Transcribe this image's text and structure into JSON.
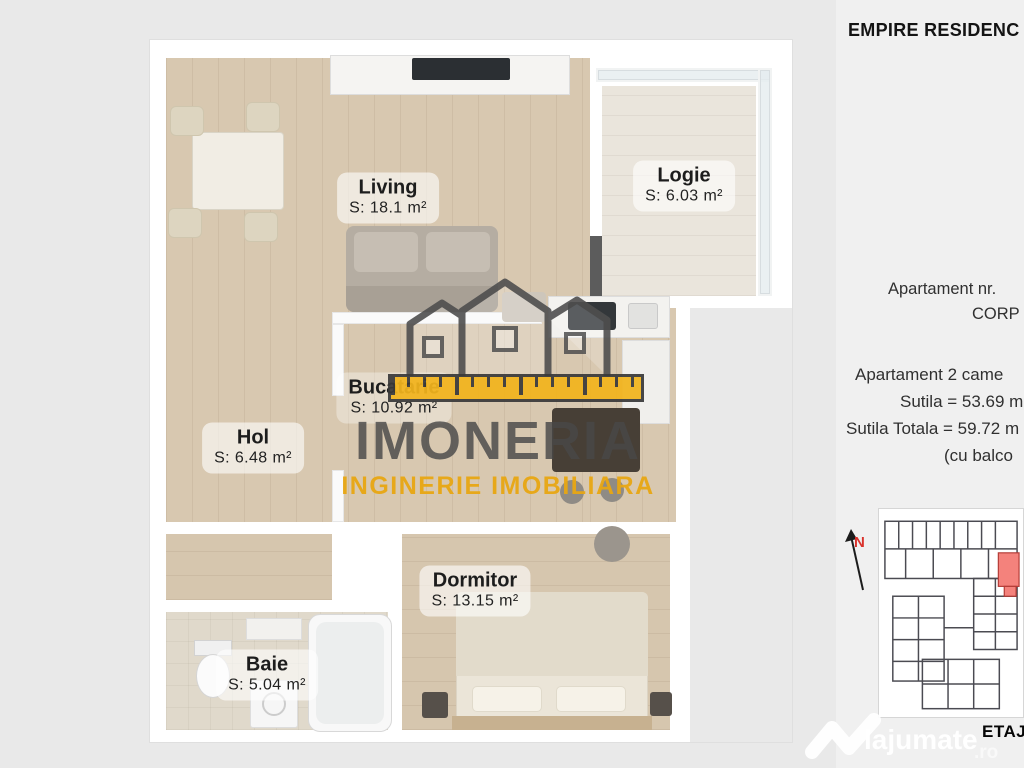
{
  "colors": {
    "background": "#e9e9e9",
    "panel_background": "#f0f0f0",
    "plan_background": "#ffffff",
    "wood_floor": "#d8c8b0",
    "brand_gray": "#4a4a4a",
    "brand_yellow": "#eead17",
    "highlight_red": "#f4827c"
  },
  "plan": {
    "rooms": [
      {
        "name": "Living",
        "area": "S: 18.1 m²"
      },
      {
        "name": "Logie",
        "area": "S: 6.03 m²"
      },
      {
        "name": "Bucatarie",
        "area": "S: 10.92 m²"
      },
      {
        "name": "Hol",
        "area": "S: 6.48 m²"
      },
      {
        "name": "Dormitor",
        "area": "S: 13.15 m²"
      },
      {
        "name": "Baie",
        "area": "S: 5.04 m²"
      }
    ],
    "watermark": {
      "brand": "IMONERIA",
      "tagline": "INGINERIE IMOBILIARA"
    }
  },
  "panel": {
    "title": "EMPIRE RESIDENC",
    "apartment_line": "Apartament nr.",
    "corp_line": "CORP",
    "details": [
      "Apartament 2 came",
      "Sutila = 53.69 m",
      "Sutila Totala = 59.72 m",
      "(cu balco"
    ],
    "compass_label": "N",
    "floor_label": "ETAJ"
  },
  "site_watermark": {
    "brand": "lajumate",
    "tld": ".ro"
  }
}
